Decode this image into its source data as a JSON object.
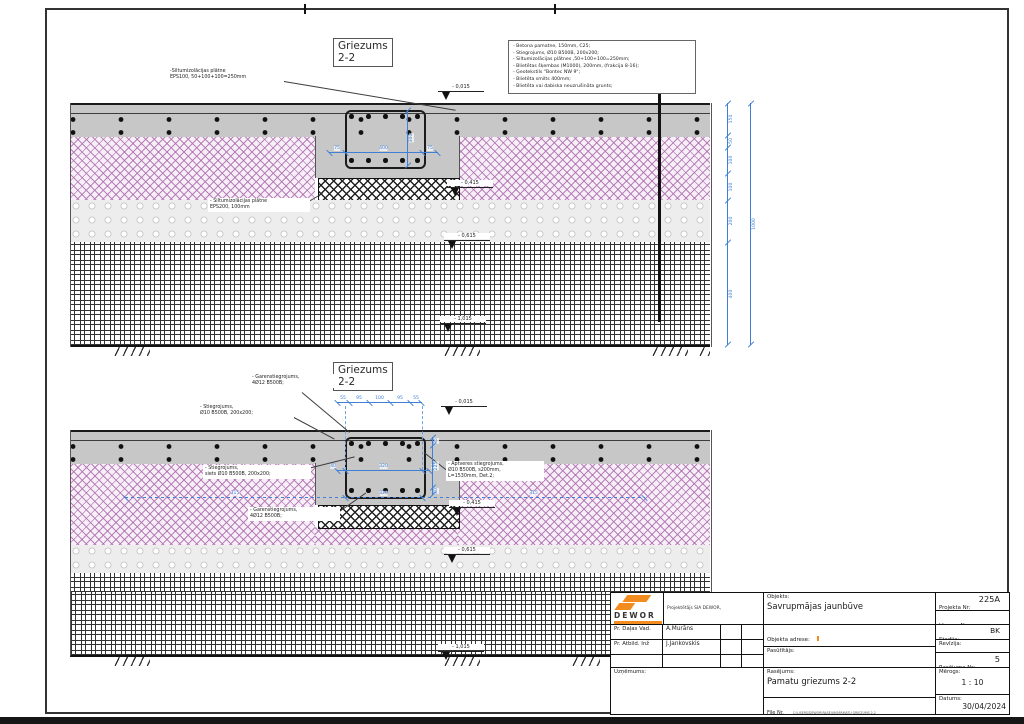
{
  "sheet": {
    "section_title": "Griezums",
    "section_number": "2-2"
  },
  "notes": [
    "- Betona pamatne, 150mm, C25;",
    "- Stiegrojums, Ø10 B500B, 200x200;",
    "- Siltumizolācijas plātnes ,50+100+100=250mm;",
    "- Blietētas šķembas (M1000), 200mm, (frakcija 8-16);",
    "- Ģeotekstils \"Bontec NW 9\";",
    "- Blietēta smilts 400mm;",
    "- Blietēta vai dabiska neuzrušināta grunts;"
  ],
  "top": {
    "label_eps100": "-Siltumizolācijas plātne\nEPS100, 50+100+100=250mm",
    "label_eps200": "- Siltumizolācijas plātne\nEPS200, 100mm",
    "lvl": [
      "- 0,015",
      "- 0,415",
      "- 0,615",
      "- 1,015"
    ],
    "dim_width": [
      "75",
      "400",
      "75"
    ],
    "dim_height": "300",
    "chain": [
      "150",
      "50",
      "100",
      "100",
      "200",
      "400"
    ],
    "total": "1000"
  },
  "bottom": {
    "label_garen_top": "- Garenstiegrojums,\n4Ø12 B500B;",
    "label_stiegrojums": "- Stiegrojums,\nØ10 B500B, 200x200;",
    "label_siets": "- Stiegrojums,\nsiets Ø10 B500B, 200x200;",
    "label_garen_bottom": "- Garenstiegrojums,\n4Ø12 B500B;",
    "label_aptveres": "- Aptveres stiegrojums,\nØ10 B500B, s200mm,\nL=1530mm, Det.2;",
    "lvl": [
      "- 0,015",
      "- 0,415",
      "- 0,615",
      "- 1,015"
    ],
    "chain_top": [
      "55",
      "95",
      "100",
      "95",
      "55"
    ],
    "dim_cage": [
      "40",
      "320",
      "40"
    ],
    "dim_vert": [
      "35",
      "225",
      "40"
    ],
    "chain_bottom": [
      "315",
      "320",
      "315"
    ]
  },
  "titleblock": {
    "brand": "DEWOR",
    "company_info": "Projektētājs SIA DEWOR,\nReģ. Nr 40203121277\nŠis rasējums nav izmantojams\nbez saskaņošanas ar",
    "role1_label": "Pr. Daļas Vad.",
    "role1_value": "A.Murāns",
    "role2_label": "Pr. Atbild. Inž",
    "role2_value": "J.Jankovskis",
    "company_label": "Uzņēmums:",
    "objekts_label": "Objekts:",
    "objekts_value": "Savrupmājas jaunbūve",
    "adrese_label": "Objekta adrese:",
    "pasutitajs_label": "Pasūtītājs:",
    "rasejums_label": "Rasējums:",
    "rasejums_value": "Pamatu griezums 2-2",
    "file_label": "File Nr.",
    "file_value": "C:\\USERS\\DEWOR\\RASEJUMI\\PAMATU GRIEZUMS 2-2",
    "projekta_label": "Projekta Nr:",
    "projekta_value": "225A",
    "liguma_label": "Līguma Nr.:",
    "liguma_value": "DEWOR/2024-2024",
    "stadija_label": "Stadija:",
    "stadija_value": "BK",
    "revizija_label": "Revīzija:",
    "ras_nr_label": "Rasējuma Nr:",
    "ras_nr_value": "5",
    "merogs_label": "Mērogs:",
    "merogs_value": "1 : 10",
    "datums_label": "Datums:",
    "datums_value": "30/04/2024"
  },
  "colors": {
    "dimension_blue": "#3f7fd6",
    "brand_orange": "#f28c1e",
    "insulation_pink": "#ad6ead"
  }
}
